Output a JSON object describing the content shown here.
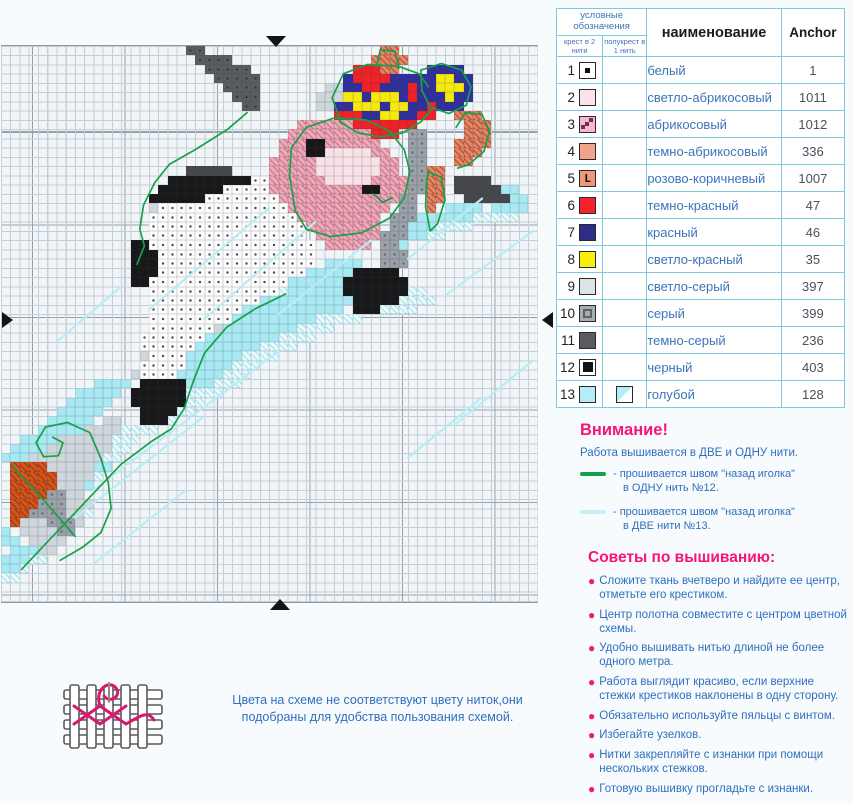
{
  "chart": {
    "cell_size": 9.25,
    "cols": 58,
    "rows": 60,
    "bg": "#f1f5f7",
    "grid_line": "#c3ced6",
    "grid_bold": "#94a2ae",
    "palette": {
      "T": {
        "color": "#5a5d60",
        "dot": "#35373a"
      },
      "B": {
        "color": "#18181a"
      },
      "D": {
        "color": "#46484c"
      },
      "G": {
        "color": "#9aa1a8",
        "dot": "#63696f"
      },
      "L": {
        "color": "#cfd7dc"
      },
      "W": {
        "color": "#fdfdfe",
        "dot": "#4a4a4a"
      },
      "P": {
        "color": "#efaab8",
        "hatch": "#d17d96"
      },
      "M": {
        "color": "#f9e2e8"
      },
      "A": {
        "color": "#e2886a",
        "hatch": "#c05636"
      },
      "R": {
        "color": "#ee2228"
      },
      "N": {
        "color": "#31309a"
      },
      "Y": {
        "color": "#f6e90c"
      },
      "C": {
        "color": "#a9e9f3"
      },
      "c": {
        "color": "#eef9fc",
        "hatch": "#ade9f3"
      },
      "O": {
        "color": "#d4561e",
        "hatch": "#a83c10"
      }
    },
    "pixel_map": [
      "....................TT...................AA...............",
      ".....................TTTT...............AAAA..............",
      "......................TTTTT...........RRRAA...NNNN........",
      ".......................TTTTT.........NRRRRNNNNNYYNN.......",
      "........................TTTT.......LLNNRRNNNRNNYYYN.......",
      ".........................TTT......LLLYYNYYYNRNNNYNN.......",
      "..........................TT......LLNNYYYNYYNNRNNN........",
      "....................................RRRNNYYNNRR..AAA......",
      "................................PPPPPPRRRRRRR.....AAA.....",
      "...............................PPPPPPPPPRRR.GG....AAA.....",
      "..............................PPPBBPPPPPP...GG...AAAA.....",
      "..............................PPPBBMMMMMPP..GG...AAA......",
      ".............................PPPPPMMMMMMMPP.GG...AA.......",
      "....................DDDDD....PPPPPMMMMMMMPP.GGAA..........",
      "..................BBBBBBBBBWWPPPPPPMMMMMPPPPGGAA.DDDD.....",
      ".................BBBBBBBWWWWWPPPPPPPPPPBBPPPGGAA.DDDDDCC..",
      "................BBBBBBWWWWWWWWPPPPPPPPPPPPPGG.AA..DDDDDCC.",
      "................LWWWWWWWWWWWWWWPPPPPPPPPPP.GG.A.CCCC.CCCC.",
      "................WWWWWWWWWWWWWWWWPPPPPPPPP.GGGCCCCCCccccc..",
      "................WWWWWWWWWWWWWWWWWPPPPPPPP.GGCCCcccc.......",
      "................WWWWWWWWWWWWWWWWW.PPPPPPPGGGCCcc..........",
      "..............BBWWWWWWWWWWWWWWWWWW.PPPPP.GGC..............",
      "..............BBBWWWWWWWWWWWWWWWWW.......GGG..............",
      "..............BBBWWWWWWWWWWWWWWWWW.CCCC..GGG..............",
      "..............BBBWWWWWWWWWWWWWWWWCCCCCBBBBB...............",
      "..............BBWWWWWWWWWWWWWWWCCCCCCBBBBBBB..............",
      "................WWWWWWWWWWWWWWcCCCCCCBBBBBBBcc............",
      "................WWWWWWWWWWWWCCCCCCCCCCBBBBBcccc...........",
      "................WWWWWWWWWWCCCCCCCCCCC.BBBcccc.............",
      "................WWWWWWWWWCCCCCCCCCccccc...................",
      "................WWWWWWWLCCCCCCCCcccc......................",
      "...............WWWWWWWCCCCCCCCcccc........................",
      "...............WWWWWWCCCCCCCcccc..........................",
      "...............LWWWWCCCCCCcccc............................",
      "...............WWWWWCCCCCccc..............................",
      "..............LWWWWCCCCCccc...............................",
      "..........CCCC.BBBBBCCCccc................................",
      "........CCCCC.BBBBBBcccc..................................",
      ".......CCCCC..BBBBBBcc....................................",
      "......CCCCC....BBBBcc.....................................",
      ".....CCCCC.LL..BBBc.......................................",
      "....CCCCCLLLLcccc.........................................",
      "..CCCCLLLLLLccc...........................................",
      ".CCCCLLLLLLLcc............................................",
      "CCCLLLLLLLLcc.............................................",
      ".OOOOLLLLLCC..............................................",
      ".OOOOOLLLLc...............................................",
      ".OOOOOLLLC................................................",
      ".OOOOGGLL.................................................",
      ".OOOGGGLLL................................................",
      ".OOGGGGLLc................................................",
      ".OLLLGGGL.................................................",
      "C.LLLLGG..................................................",
      "CC.LLLL...................................................",
      ".CCCLL....................................................",
      "CCCcc.....................................................",
      "CCc.......................................................",
      "cc........................................................",
      "..........................................................",
      ".........................................................."
    ],
    "backstitch": {
      "green": {
        "color": "#17a04a",
        "paths": [
          [
            [
              26.6,
              7.2
            ],
            [
              24.5,
              9.0
            ],
            [
              21.0,
              11.2
            ],
            [
              18.2,
              12.8
            ],
            [
              16.6,
              14.8
            ],
            [
              15.4,
              17.2
            ],
            [
              15.0,
              19.8
            ],
            [
              15.5,
              21.6
            ],
            [
              14.7,
              23.6
            ]
          ],
          [
            [
              31.2,
              14.0
            ],
            [
              31.4,
              11.0
            ],
            [
              33.0,
              8.8
            ],
            [
              36.0,
              7.8
            ],
            [
              39.5,
              8.0
            ],
            [
              42.0,
              9.2
            ],
            [
              43.6,
              11.2
            ],
            [
              44.2,
              13.6
            ],
            [
              43.6,
              16.4
            ],
            [
              42.0,
              18.6
            ],
            [
              39.0,
              20.2
            ],
            [
              35.6,
              20.6
            ],
            [
              33.0,
              19.8
            ],
            [
              31.8,
              17.8
            ],
            [
              31.2,
              14.0
            ]
          ],
          [
            [
              40.2,
              16.0
            ],
            [
              41.3,
              16.9
            ],
            [
              42.3,
              16.4
            ]
          ],
          [
            [
              40.6,
              2.2
            ],
            [
              41.0,
              0.4
            ],
            [
              42.6,
              0.6
            ],
            [
              43.0,
              2.4
            ]
          ],
          [
            [
              36.8,
              8.4
            ],
            [
              35.8,
              5.6
            ],
            [
              37.0,
              3.0
            ],
            [
              39.6,
              2.0
            ],
            [
              43.0,
              2.2
            ],
            [
              45.2,
              3.0
            ],
            [
              46.2,
              4.4
            ]
          ],
          [
            [
              45.4,
              2.6
            ],
            [
              47.6,
              1.9
            ],
            [
              49.8,
              2.6
            ],
            [
              50.8,
              4.4
            ],
            [
              50.3,
              6.4
            ],
            [
              48.4,
              7.3
            ],
            [
              46.4,
              6.6
            ],
            [
              45.5,
              4.8
            ],
            [
              45.4,
              2.6
            ]
          ],
          [
            [
              36.6,
              8.2
            ],
            [
              38.6,
              9.4
            ],
            [
              41.0,
              9.8
            ],
            [
              43.4,
              9.4
            ],
            [
              45.4,
              8.2
            ],
            [
              46.6,
              6.8
            ]
          ],
          [
            [
              49.2,
              8.8
            ],
            [
              50.2,
              7.2
            ],
            [
              52.0,
              7.4
            ],
            [
              52.8,
              9.2
            ],
            [
              52.2,
              11.4
            ],
            [
              50.6,
              12.8
            ],
            [
              49.4,
              13.2
            ]
          ],
          [
            [
              46.2,
              13.6
            ],
            [
              47.6,
              14.2
            ],
            [
              48.0,
              16.6
            ],
            [
              47.2,
              19.2
            ],
            [
              46.4,
              20.0
            ],
            [
              45.9,
              17.4
            ],
            [
              46.0,
              14.6
            ],
            [
              46.2,
              13.6
            ]
          ],
          [
            [
              30.8,
              26.8
            ],
            [
              27.5,
              28.4
            ],
            [
              24.4,
              30.4
            ],
            [
              22.0,
              33.2
            ],
            [
              20.8,
              36.2
            ],
            [
              19.8,
              39.2
            ],
            [
              18.4,
              41.4
            ],
            [
              16.2,
              42.8
            ],
            [
              13.0,
              45.2
            ],
            [
              9.2,
              49.2
            ],
            [
              5.4,
              53.2
            ],
            [
              2.2,
              56.6
            ]
          ],
          [
            [
              10.8,
              44.6
            ],
            [
              9.6,
              41.8
            ],
            [
              7.2,
              40.7
            ],
            [
              4.8,
              41.2
            ],
            [
              3.8,
              42.9
            ],
            [
              4.6,
              44.4
            ],
            [
              6.2,
              44.3
            ],
            [
              6.7,
              42.9
            ],
            [
              5.6,
              42.3
            ]
          ],
          [
            [
              10.8,
              44.6
            ],
            [
              11.6,
              47.2
            ],
            [
              11.9,
              50.0
            ],
            [
              10.8,
              52.6
            ],
            [
              8.8,
              54.2
            ],
            [
              6.4,
              55.6
            ]
          ],
          [
            [
              1.2,
              45.4
            ],
            [
              4.0,
              48.4
            ],
            [
              6.8,
              51.6
            ],
            [
              8.0,
              53.0
            ]
          ]
        ]
      },
      "cyan": {
        "color": "#b9ecf5",
        "paths": [
          [
            [
              29,
              17.5
            ],
            [
              16,
              28.5
            ]
          ],
          [
            [
              34,
              19
            ],
            [
              22,
              29.5
            ]
          ],
          [
            [
              40,
              21
            ],
            [
              30,
              29
            ]
          ],
          [
            [
              52,
              16.5
            ],
            [
              44,
              23
            ]
          ],
          [
            [
              57.5,
              20
            ],
            [
              48,
              27
            ]
          ],
          [
            [
              30,
              33
            ],
            [
              14,
              45
            ]
          ],
          [
            [
              26,
              36
            ],
            [
              10,
              48
            ]
          ],
          [
            [
              22,
              40
            ],
            [
              8,
              51
            ]
          ],
          [
            [
              57.5,
              34
            ],
            [
              49,
              41
            ]
          ],
          [
            [
              52,
              38
            ],
            [
              44,
              44.5
            ]
          ],
          [
            [
              20,
              48
            ],
            [
              10,
              56
            ]
          ],
          [
            [
              13,
              26
            ],
            [
              6,
              32
            ]
          ]
        ]
      }
    },
    "marker_color": "#141414"
  },
  "legend": {
    "header": {
      "group": "условные обозначения",
      "col1": "крест в 2 нити",
      "col2": "полукрест в 1 нить",
      "name": "наименование",
      "brand": "Anchor"
    },
    "rows": [
      {
        "num": "1",
        "name": "белый",
        "anchor": "1",
        "color": "#ffffff",
        "symbol": "dot"
      },
      {
        "num": "2",
        "name": "светло-абрикосовый",
        "anchor": "1011",
        "color": "#fbe3ec",
        "symbol": "none"
      },
      {
        "num": "3",
        "name": "абрикосовый",
        "anchor": "1012",
        "color": "#f5b8cf",
        "symbol": "diag"
      },
      {
        "num": "4",
        "name": "темно-абрикосовый",
        "anchor": "336",
        "color": "#f2a38c",
        "symbol": "none"
      },
      {
        "num": "5",
        "name": "розово-коричневый",
        "anchor": "1007",
        "color": "#ef977d",
        "symbol": "L"
      },
      {
        "num": "6",
        "name": "темно-красный",
        "anchor": "47",
        "color": "#f3232b",
        "symbol": "none"
      },
      {
        "num": "7",
        "name": "красный",
        "anchor": "46",
        "color": "#2e2d85",
        "symbol": "none"
      },
      {
        "num": "8",
        "name": "светло-красный",
        "anchor": "35",
        "color": "#f8ef0a",
        "symbol": "none"
      },
      {
        "num": "9",
        "name": "светло-серый",
        "anchor": "397",
        "color": "#dde4e9",
        "symbol": "none"
      },
      {
        "num": "10",
        "name": "серый",
        "anchor": "399",
        "color": "#a7aeb3",
        "symbol": "inner"
      },
      {
        "num": "11",
        "name": "темно-серый",
        "anchor": "236",
        "color": "#595b5e",
        "symbol": "none"
      },
      {
        "num": "12",
        "name": "черный",
        "anchor": "403",
        "color": "#ffffff",
        "symbol": "bigblack"
      },
      {
        "num": "13",
        "name": "голубой",
        "anchor": "128",
        "color": "#b5edf6",
        "symbol": "none",
        "half": true
      }
    ]
  },
  "attention": {
    "heading": "Внимание!",
    "intro": "Работа вышивается в ДВЕ и ОДНУ нити.",
    "items": [
      {
        "color": "#12a24d",
        "line1": "- прошивается швом \"назад иголка\"",
        "line2": "в ОДНУ нить №12."
      },
      {
        "color": "#c6f0f8",
        "line1": "- прошивается швом \"назад иголка\"",
        "line2": "в ДВЕ нити №13."
      }
    ]
  },
  "tips": {
    "heading": "Советы по вышиванию:",
    "items": [
      "Сложите ткань вчетверо и найдите ее центр, отметьте его крестиком.",
      "Центр полотна совместите с центром цветной схемы.",
      "Удобно вышивать нитью длиной не более одного метра.",
      "Работа выглядит красиво, если верхние стежки крестиков наклонены в одну сторону.",
      "Обязательно используйте пяльцы с винтом.",
      "Избегайте узелков.",
      "Нитки закрепляйте с изнанки при помощи нескольких стежков.",
      "Готовую вышивку прогладьте с изнанки."
    ]
  },
  "footer": {
    "note_line1": "Цвета на схеме не соответствуют цвету ниток,они",
    "note_line2": "подобраны для удобства пользования схемой.",
    "thread_color": "#d6186e"
  }
}
